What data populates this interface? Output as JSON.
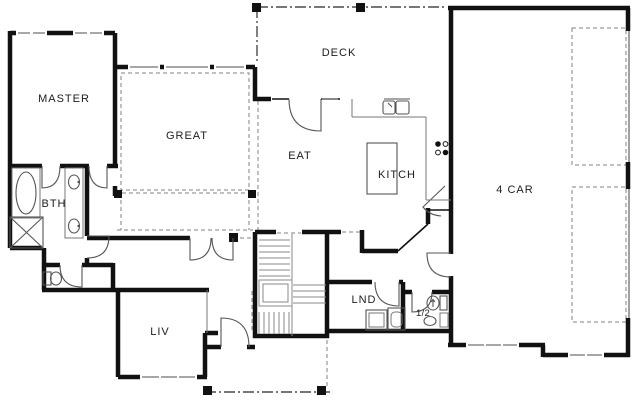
{
  "drawing": {
    "type": "residential-floor-plan",
    "colors": {
      "background": "#ffffff",
      "walls": "#111111",
      "fixtures": "#555555",
      "windows": "#8a8a8a",
      "dashed_lines": "#808080"
    },
    "rooms": {
      "master": {
        "label": "MASTER"
      },
      "bath": {
        "label": "BTH"
      },
      "great": {
        "label": "GREAT"
      },
      "deck": {
        "label": "DECK"
      },
      "eat": {
        "label": "EAT"
      },
      "kitchen": {
        "label": "KITCH"
      },
      "garage": {
        "label": "4 CAR"
      },
      "living": {
        "label": "LIV"
      },
      "laundry": {
        "label": "LND"
      },
      "half_bath": {
        "label": "1/2"
      }
    }
  }
}
